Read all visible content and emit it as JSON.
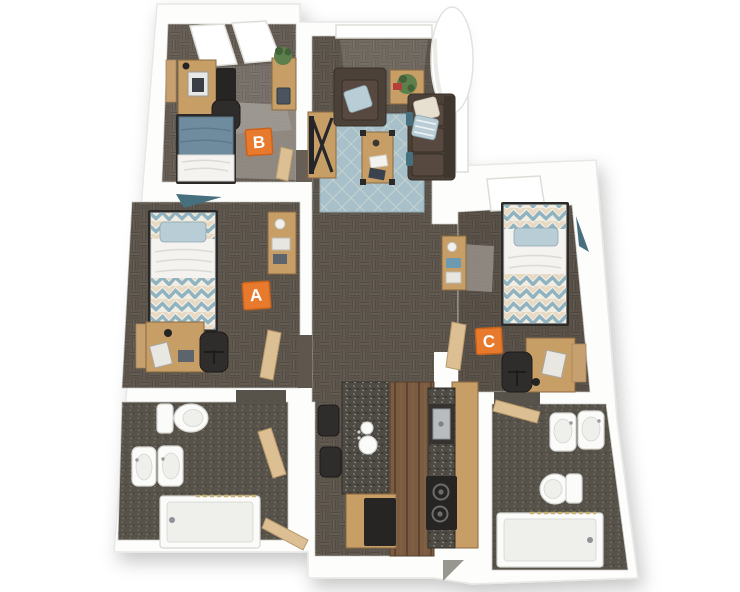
{
  "page": {
    "background": "#ffffff"
  },
  "labels": {
    "a": "A",
    "b": "B",
    "c": "C"
  },
  "colors": {
    "background": "#ffffff",
    "carpet": "#5f574d",
    "carpet_b": "#675f56",
    "carpet_c": "#5a5249",
    "bath_floor": "#57524a",
    "rug_light": "#96908a",
    "rug_blue": "#a8c0c9",
    "rug_blue_line": "#c9d8d2",
    "wood": "#c79e66",
    "wood_dark": "#8a6a42",
    "door": "#dcc094",
    "cork": "#c7a070",
    "counter_granite": "#4e4a44",
    "wood_floor": "#7b5c41",
    "appliance": "#262523",
    "fixture": "#fbfbfa",
    "fixture_shade": "#d5d5d1",
    "steel": "#b9bcbe",
    "sofa": "#4c4138",
    "sofa_dark": "#362e27",
    "pillow_cream": "#e7dfd0",
    "pillow_blue": "#b9cdd6",
    "bed_blue": "#6e8c9e",
    "sheet": "#f4f3f0",
    "chevron_blue": "#8fb3c0",
    "chevron_cream": "#e7d9c2",
    "chevron_bg": "#f2ede2",
    "plant": "#5d7f4b",
    "plant_dark": "#446238",
    "pennant": "#47707e",
    "accent_red": "#b5403a",
    "label_bg": "#e87a2e",
    "label_edge": "#c9621d",
    "label_text": "#ffffff",
    "entry_shadow": "#97978f"
  }
}
